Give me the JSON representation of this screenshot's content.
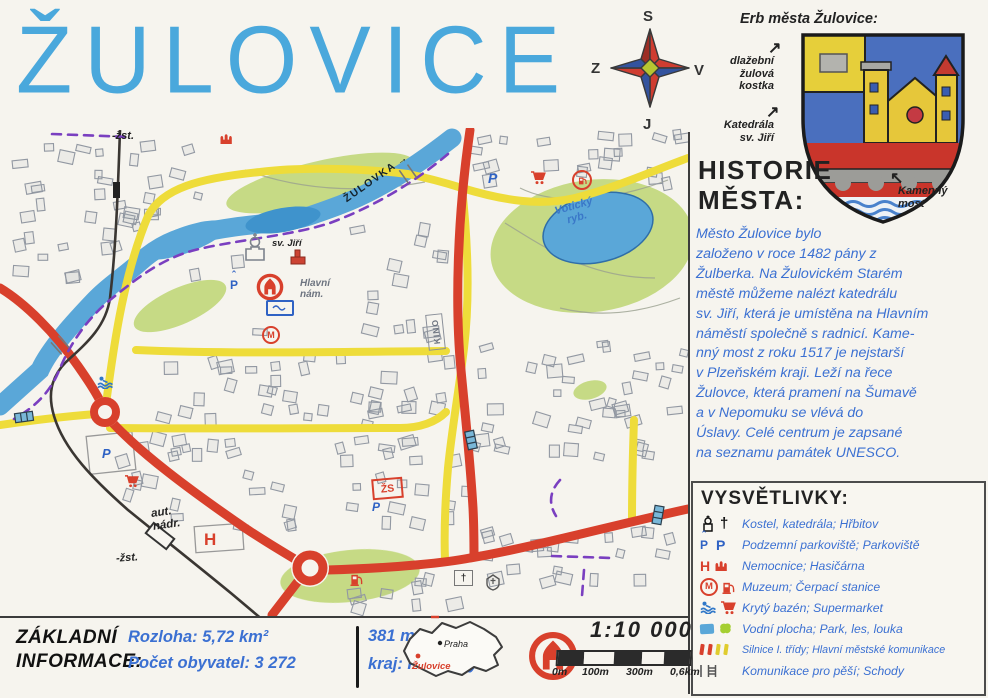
{
  "title": "ŽULOVICE",
  "compass": {
    "n": "S",
    "e": "V",
    "s": "J",
    "w": "Z"
  },
  "coat_of_arms": {
    "caption": "Erb města Žulovice:",
    "label_cobble": "dlažební\nžulová\nkostka",
    "label_cathedral": "Katedrála\nsv. Jiří",
    "label_bridge": "Kamenný\nmost"
  },
  "history": {
    "heading": "HISTORIE\nMĚSTA:",
    "body": "Město Žulovice bylo\nzaloženo v roce 1482 pány z\nŽulberka. Na Žulovickém Starém\nměstě můžeme nalézt katedrálu\nsv. Jiří, která je umístěna na Hlavním\nnáměstí společně s radnicí. Kame-\nnný most z roku 1517 je nejstarší\nv Plzeňském kraji. Leží na řece\nŽulovce, která pramení na Šumavě\na v Nepomuku se vlévá do\nÚslavy. Celé centrum je zapsané\nna seznamu památek UNESCO."
  },
  "legend": {
    "title": "VYSVĚTLIVKY:",
    "items": [
      {
        "label": "Kostel, katedrála; Hřbitov"
      },
      {
        "label": "Podzemní parkoviště; Parkoviště",
        "glyphs": {
          "a": "P",
          "b": "P"
        }
      },
      {
        "label": "Nemocnice; Hasičárna",
        "glyphs": {
          "a": "H"
        }
      },
      {
        "label": "Muzeum; Čerpací stanice",
        "glyphs": {
          "a": "M"
        }
      },
      {
        "label": "Krytý bazén; Supermarket"
      },
      {
        "label": "Vodní plocha; Park, les, louka"
      },
      {
        "label": "Silnice I. třídy; Hlavní městské komunikace"
      },
      {
        "label": "Komunikace pro pěší; Schody"
      }
    ]
  },
  "info": {
    "heading": "ZÁKLADNÍ\nINFORMACE:",
    "area": "Rozloha: 5,72 km²",
    "population": "Počet obyvatel: 3 272",
    "elevation": "381 m.n.m.",
    "region": "kraj: Plzeňský"
  },
  "minimap": {
    "capital": "Praha",
    "town": "Žulovice"
  },
  "scale": {
    "ratio": "1:10 000",
    "ticks": [
      "0m",
      "100m",
      "300m",
      "0,6km"
    ]
  },
  "map": {
    "labels": {
      "river": "ŽULOVKA",
      "pond": "Votický\nryb.",
      "station_top": "-žst.",
      "station_bottom": "-žst.",
      "church": "sv. Jiří",
      "square": "Hlavní\nnám.",
      "bus_station": "aut.\nnádr.",
      "cinema": "KINO",
      "school": "ŽS",
      "hospital": "H",
      "parking": "P",
      "museum": "M"
    }
  },
  "icons": {
    "arrow_right": "→",
    "arrow_ne": "↗",
    "arrow_nw": "↖",
    "cross": "†",
    "caret": "ˆ"
  },
  "colors": {
    "title_blue": "#4aa8dc",
    "pen_blue": "#3b70d2",
    "road_red": "#d8402c",
    "road_yellow": "#eedc3a",
    "river_blue": "#5aa7d8",
    "park_green": "#c3d97f",
    "path_purple": "#7a3fc0",
    "pencil_gray": "#8f96a0",
    "marker_black": "#1f1f1f"
  }
}
